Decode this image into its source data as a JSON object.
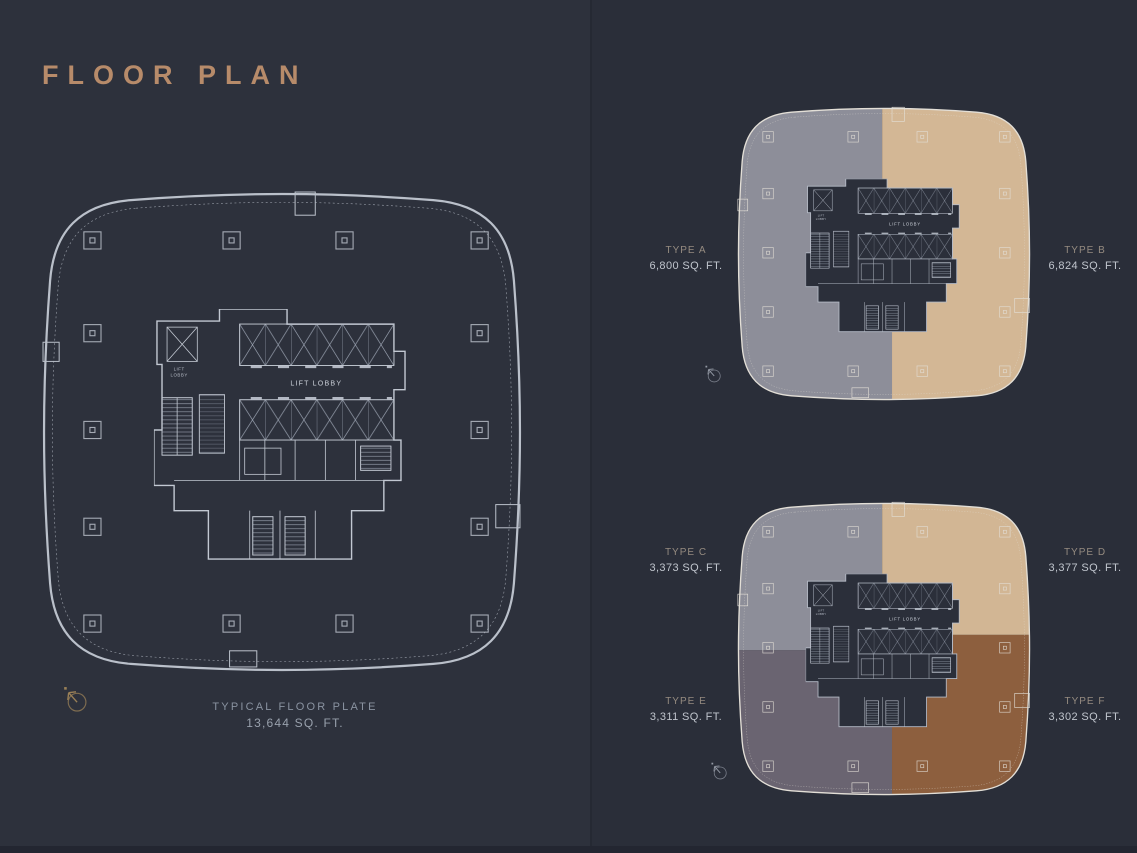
{
  "page": {
    "title": "FLOOR PLAN",
    "background_color": "#2d313c",
    "accent_color": "#b78b6a"
  },
  "main_plan": {
    "caption_line1": "TYPICAL FLOOR PLATE",
    "caption_line2": "13,644 SQ. FT.",
    "lift_lobby_label": "LIFT LOBBY",
    "lift_small_1": "LIFT",
    "lift_small_2": "LOBBY"
  },
  "unit_plans": {
    "top": {
      "units": [
        {
          "id": "A",
          "name": "TYPE A",
          "area": "6,800 SQ. FT.",
          "color": "#8d8e99"
        },
        {
          "id": "B",
          "name": "TYPE B",
          "area": "6,824 SQ. FT.",
          "color": "#d3b795"
        }
      ]
    },
    "bottom": {
      "units": [
        {
          "id": "C",
          "name": "TYPE C",
          "area": "3,373 SQ. FT.",
          "color": "#8d8e99"
        },
        {
          "id": "D",
          "name": "TYPE D",
          "area": "3,377 SQ. FT.",
          "color": "#d2b694"
        },
        {
          "id": "E",
          "name": "TYPE E",
          "area": "3,311 SQ. FT.",
          "color": "#6a6471"
        },
        {
          "id": "F",
          "name": "TYPE F",
          "area": "3,302 SQ. FT.",
          "color": "#8d5f3e"
        }
      ]
    }
  }
}
